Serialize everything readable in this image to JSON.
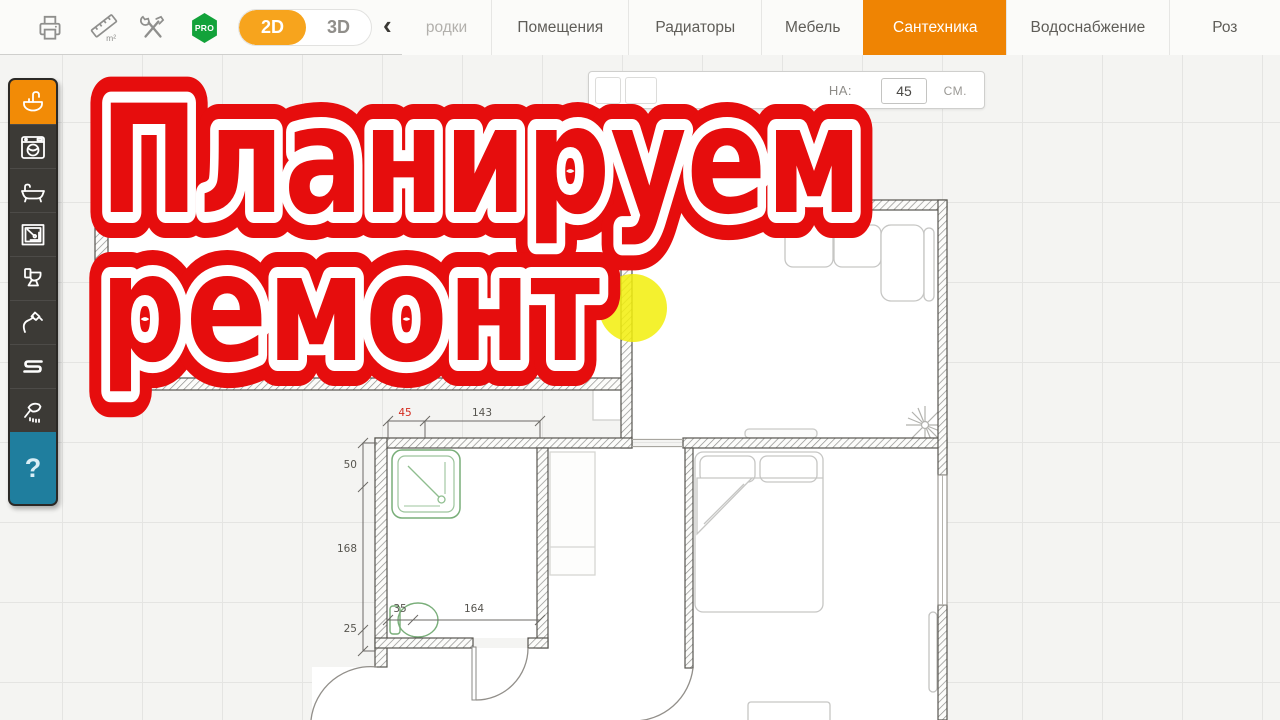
{
  "toolbar": {
    "pro_badge": "PRO",
    "view_2d": "2D",
    "view_3d": "3D",
    "back_chevron": "‹",
    "ruler_unit": "m²"
  },
  "tabs": [
    {
      "label": "родки",
      "active": false,
      "partial": true
    },
    {
      "label": "Помещения",
      "active": false
    },
    {
      "label": "Радиаторы",
      "active": false
    },
    {
      "label": "Мебель",
      "active": false
    },
    {
      "label": "Сантехника",
      "active": true
    },
    {
      "label": "Водоснабжение",
      "active": false
    },
    {
      "label": "Роз",
      "active": false,
      "clipped": true
    }
  ],
  "sidebar": {
    "items": [
      {
        "icon": "sink-icon",
        "active": true
      },
      {
        "icon": "washing-machine-icon",
        "active": false
      },
      {
        "icon": "bathtub-icon",
        "active": false
      },
      {
        "icon": "shower-cabin-icon",
        "active": false
      },
      {
        "icon": "toilet-icon",
        "active": false
      },
      {
        "icon": "hygienic-sprayer-icon",
        "active": false
      },
      {
        "icon": "towel-rail-icon",
        "active": false
      },
      {
        "icon": "shower-head-icon",
        "active": false
      }
    ],
    "help_label": "?"
  },
  "property_bar": {
    "label_fragment": "НА:",
    "value": "45",
    "unit": "см."
  },
  "overlay": {
    "line1": "Планируем",
    "line2": "ремонт",
    "text_color": "#e60d0d",
    "outline_color": "#ffffff"
  },
  "plan": {
    "dims": {
      "height_50": "50",
      "height_168": "168",
      "height_25": "25",
      "width_35": "35",
      "width_164": "164",
      "width_45": "45",
      "width_143": "143"
    },
    "highlight_color": "#f2ee0b"
  },
  "colors": {
    "active_tab": "#ef8403",
    "toggle_2d": "#f7a41d",
    "sidebar_active": "#f28b06",
    "pro_green": "#12a23a",
    "help_blue": "#1f7e9e"
  }
}
